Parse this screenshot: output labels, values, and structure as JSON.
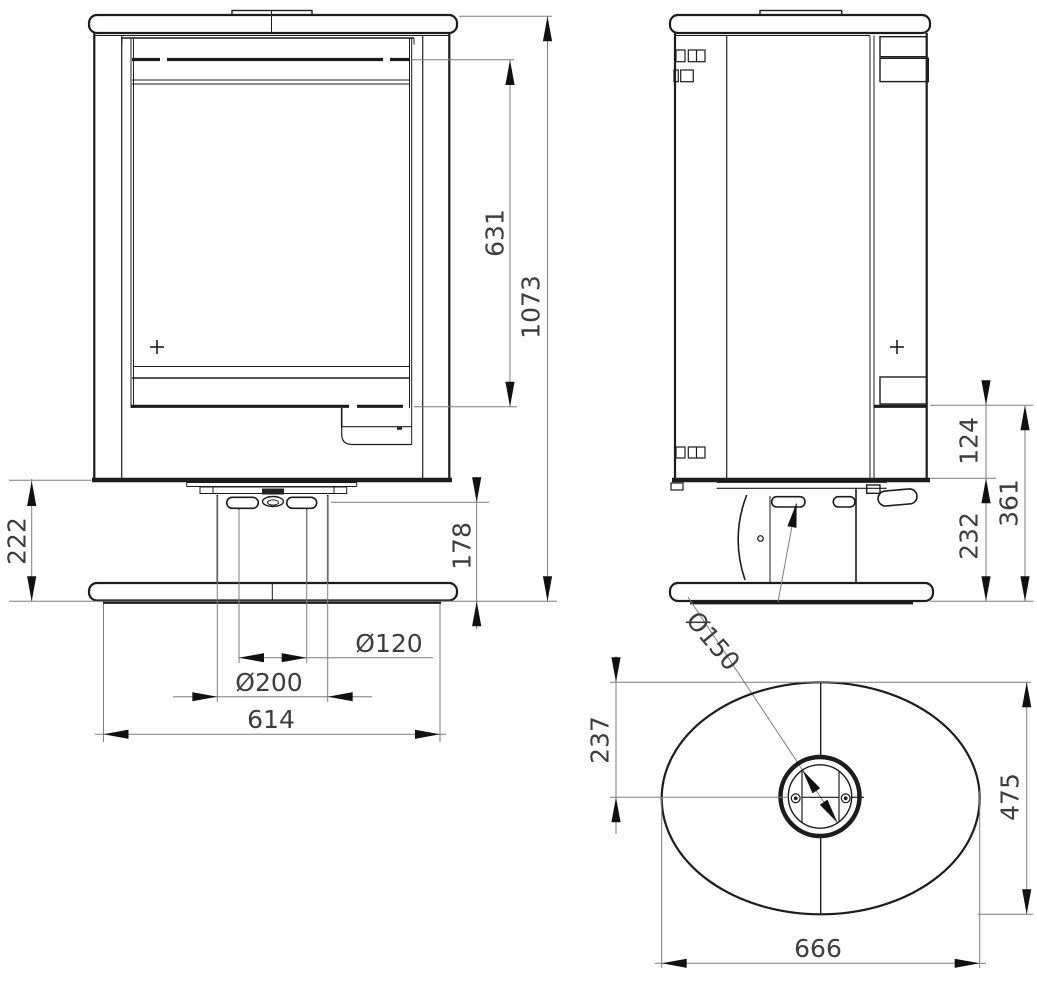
{
  "drawing_type": "stove technical dimension drawing, three views",
  "colors": {
    "background": "#ffffff",
    "object_line": "#1c1c1c",
    "dimension_line": "#7d7d7d",
    "dimension_text": "#3d3d3d",
    "arrow": "#111111"
  },
  "dims": {
    "d631": "631",
    "d1073": "1073",
    "d222": "222",
    "d178": "178",
    "d120": "Ø120",
    "d200": "Ø200",
    "d614": "614",
    "d124": "124",
    "d232": "232",
    "d361": "361",
    "d150": "Ø150",
    "d237": "237",
    "d475": "475",
    "d666": "666"
  }
}
